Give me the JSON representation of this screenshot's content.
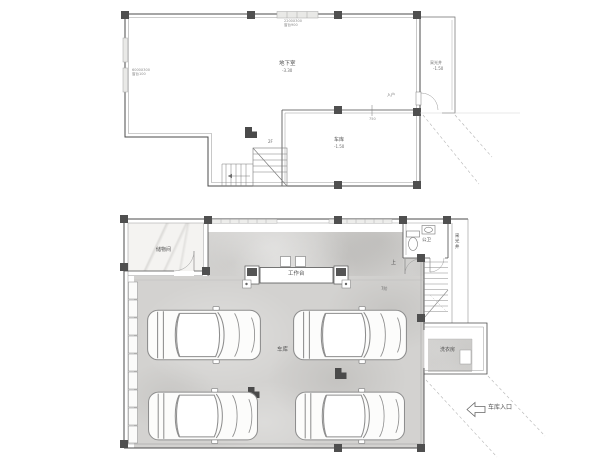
{
  "colors": {
    "wall": "#4a4a4a",
    "wall_light": "#9b9b9b",
    "floor_concrete": "#d3d2d0",
    "floor_marble": "#f4f3f1",
    "text": "#4f4f4f"
  },
  "upper_plan": {
    "room": {
      "label": "地下室",
      "level": "-3.30"
    },
    "lightwell": {
      "label": "采光井",
      "level": "-1.50"
    },
    "garage_area": {
      "label": "车库",
      "level": "-1.50"
    },
    "stairs_note": "2F",
    "entry_note": "入户",
    "dim_note": "750",
    "window_note_top": {
      "line1": "2200X300",
      "line2": "窗台900"
    },
    "window_note_left": {
      "line1": "6000X300",
      "line2": "窗台100"
    }
  },
  "lower_plan": {
    "storage": {
      "label": "储物间"
    },
    "workbench": {
      "label": "工作台"
    },
    "bathroom": {
      "label": "公卫"
    },
    "lightwell": {
      "label": "采光井"
    },
    "laundry": {
      "label": "洗衣房"
    },
    "garage": {
      "label": "车库"
    },
    "stairs": {
      "up": "上",
      "steps": "7阶"
    },
    "entrance": {
      "label": "车库入口"
    }
  }
}
